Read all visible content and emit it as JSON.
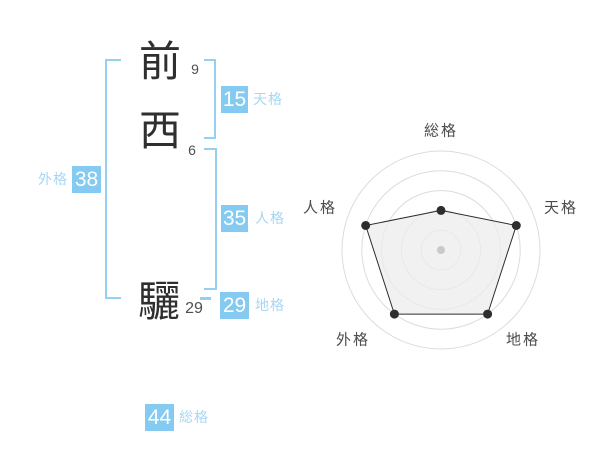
{
  "name_panel": {
    "characters": [
      {
        "char": "前",
        "strokes": "9"
      },
      {
        "char": "西",
        "strokes": "6"
      },
      {
        "char": "驪",
        "strokes": "29"
      }
    ],
    "kaku": {
      "tenkaku": {
        "value": "15",
        "label": "天格"
      },
      "jinkaku": {
        "value": "35",
        "label": "人格"
      },
      "chikaku": {
        "value": "29",
        "label": "地格"
      },
      "gaikaku": {
        "value": "38",
        "label": "外格"
      },
      "soukaku": {
        "value": "44",
        "label": "総格"
      }
    }
  },
  "colors": {
    "accent_box_blue": "#85caf0",
    "accent_label_blue": "#a7d7f3",
    "accent_bracket_blue": "#96d0f1",
    "kanji_ink": "#2f2f2f",
    "radar_grid": "#dcdcdc",
    "radar_line": "#2e2e2e",
    "radar_fill": "rgba(236,236,236,0.75)",
    "radar_center_dot": "#c9c9c9"
  },
  "chart_data": {
    "type": "radar",
    "categories": [
      "総格",
      "天格",
      "地格",
      "外格",
      "人格"
    ],
    "values": [
      2,
      4,
      4,
      4,
      4
    ],
    "max": 5,
    "rings": 5,
    "center": {
      "x": 441,
      "y": 250
    },
    "radius": 99,
    "start_angle_deg": -90,
    "grid": true,
    "legend": false,
    "title": "",
    "point_radius": 4.5
  }
}
